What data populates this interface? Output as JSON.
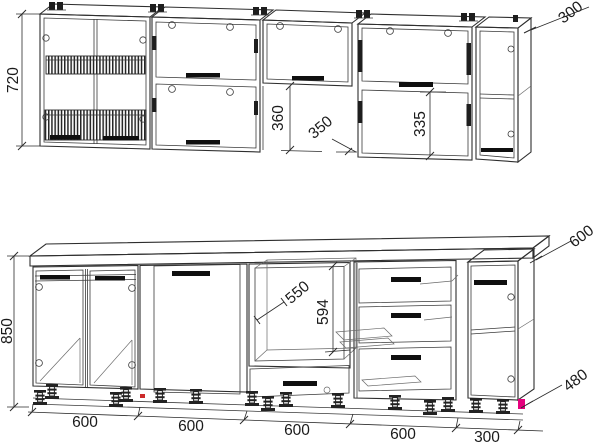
{
  "dimensions": {
    "upper_height": "720",
    "upper_end_width": "300",
    "upper_open_gap": "360",
    "upper_depth": "350",
    "upper_door_height": "335",
    "base_height": "850",
    "counter_depth": "600",
    "niche_width": "550",
    "niche_height": "594",
    "base_end_height": "480",
    "bottom_widths": [
      "600",
      "600",
      "600",
      "600",
      "300"
    ]
  },
  "colors": {
    "line": "#2e2e2e",
    "handle": "#0f0f0f",
    "accent_magenta": "#e6007e",
    "accent_red": "#cc2a2a",
    "background": "#ffffff"
  }
}
